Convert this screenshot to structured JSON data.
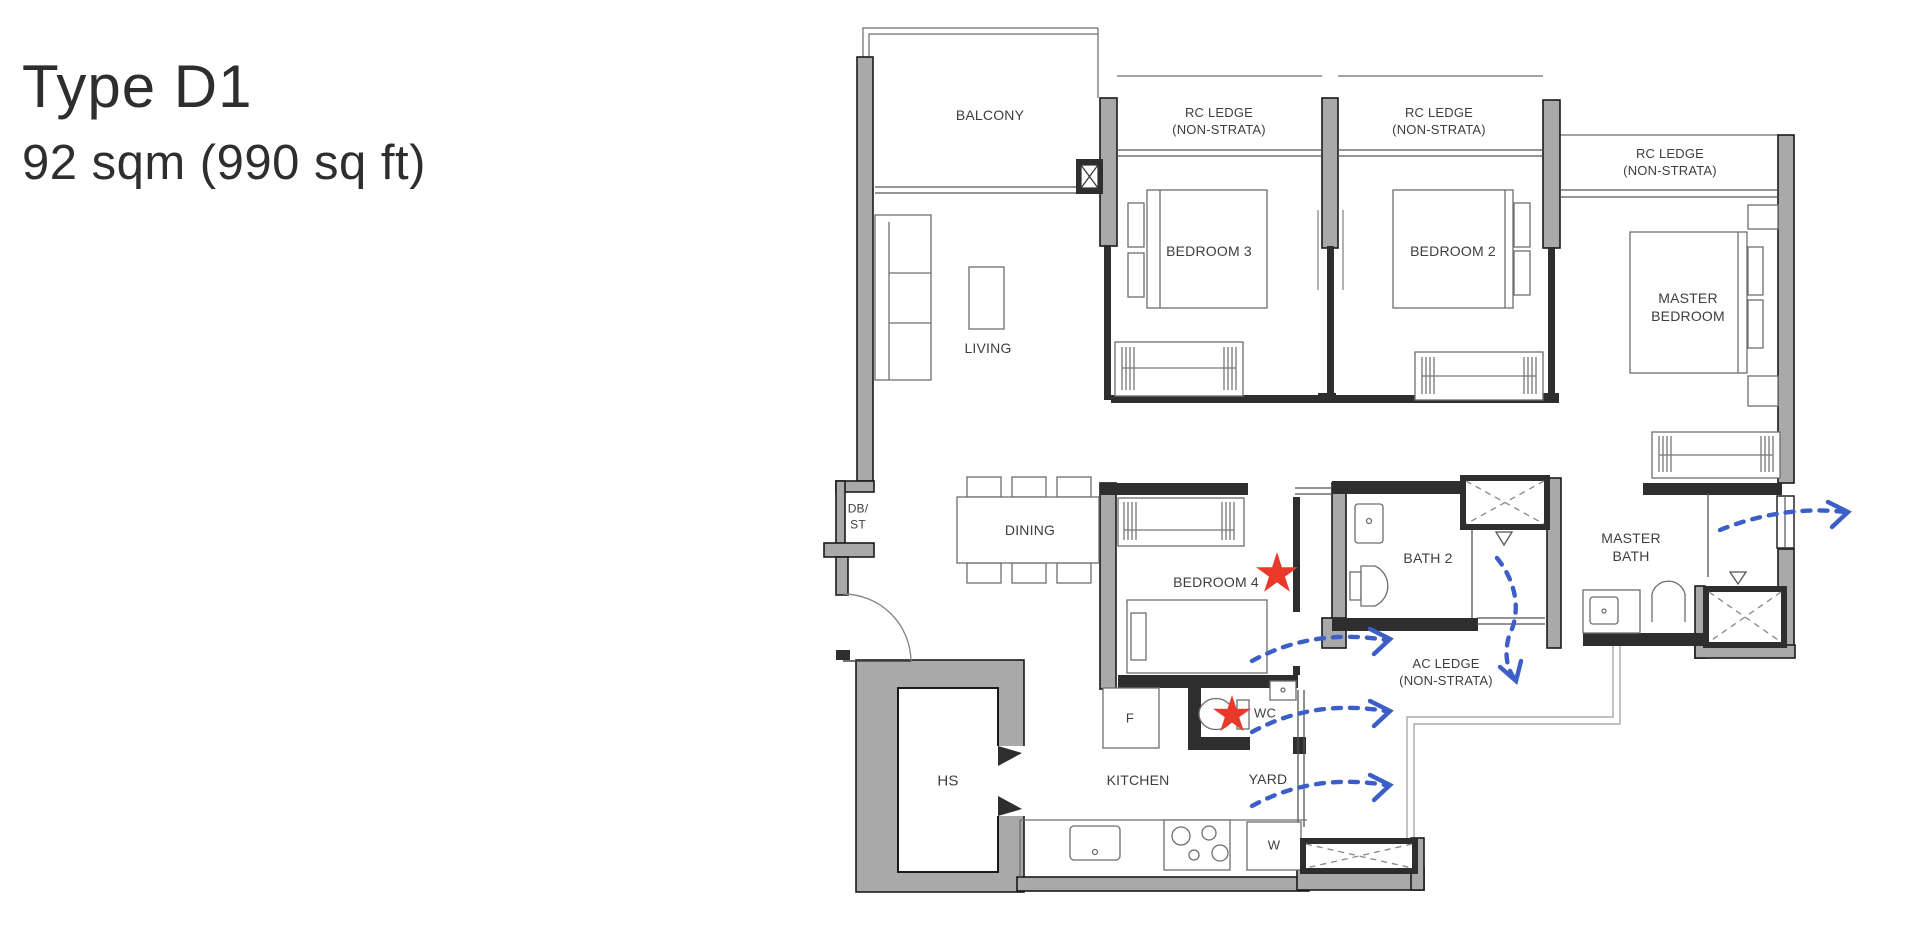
{
  "title": {
    "line1": "Type D1",
    "line2": "92 sqm (990 sq ft)"
  },
  "labels": {
    "balcony": "BALCONY",
    "rc_ledge_l1": "RC LEDGE",
    "rc_ledge_l2": "(NON-STRATA)",
    "bedroom3": "BEDROOM 3",
    "bedroom2": "BEDROOM 2",
    "master_l1": "MASTER",
    "master_bedroom_l2": "BEDROOM",
    "master_bath_l2": "BATH",
    "living": "LIVING",
    "dining": "DINING",
    "db_st_l1": "DB/",
    "db_st_l2": "ST",
    "bedroom4": "BEDROOM 4",
    "bath2": "BATH 2",
    "ac_ledge_l1": "AC LEDGE",
    "ac_ledge_l2": "(NON-STRATA)",
    "wc": "WC",
    "yard": "YARD",
    "kitchen": "KITCHEN",
    "hs": "HS",
    "fridge": "F",
    "washer": "W"
  },
  "annotations": {
    "red_star_count": 2,
    "airflow_arrow_count": 5
  },
  "colors": {
    "wall_gray": "#a9a9a9",
    "wall_dark": "#2e2e2e",
    "star_red": "#e8392b",
    "arrow_blue": "#3b5fc6",
    "text": "#3e3e3e"
  }
}
